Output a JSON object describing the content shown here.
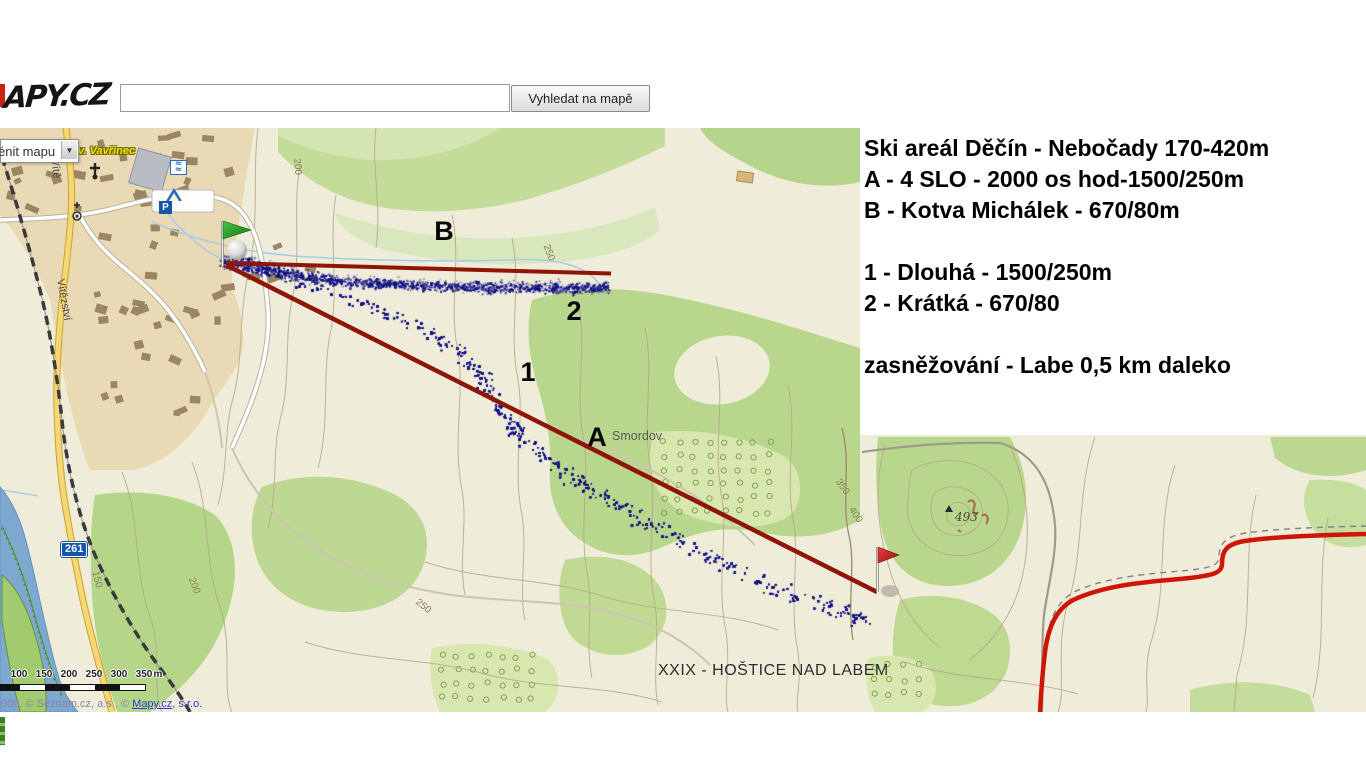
{
  "header": {
    "logo_text": "APY.CZ",
    "search_value": "",
    "search_button_label": "Vyhledat na mapě"
  },
  "map_controls": {
    "change_map_label": "énit mapu"
  },
  "info_panel": {
    "lines": [
      "Ski areál Děčín - Nebočady 170-420m",
      "A - 4 SLO - 2000 os hod-1500/250m",
      "B - Kotva Michálek - 670/80m",
      "",
      "1 - Dlouhá - 1500/250m",
      "2 - Krátká - 670/80",
      "",
      "zasněžování - Labe 0,5 km daleko"
    ]
  },
  "route_markers": [
    {
      "label": "B",
      "x": 444,
      "y": 233
    },
    {
      "label": "2",
      "x": 574,
      "y": 313
    },
    {
      "label": "1",
      "x": 528,
      "y": 374
    },
    {
      "label": "A",
      "x": 597,
      "y": 439
    }
  ],
  "place_labels": [
    {
      "text": "v. Vavřinec",
      "x": 78,
      "y": 145,
      "type": "poi",
      "rot": 0
    },
    {
      "text": "Vítě",
      "x": 60,
      "y": 158,
      "type": "street",
      "rot": 82
    },
    {
      "text": "Vítězství",
      "x": 66,
      "y": 278,
      "type": "street",
      "rot": 80
    },
    {
      "text": "Smordov",
      "x": 612,
      "y": 429,
      "type": "place",
      "rot": 0
    },
    {
      "text": "XXIX - HOŠTICE NAD LABEM",
      "x": 658,
      "y": 662,
      "type": "big",
      "rot": 0
    },
    {
      "text": "493",
      "x": 955,
      "y": 510,
      "type": "summit",
      "rot": 0
    }
  ],
  "contour_labels": [
    {
      "text": "200",
      "x": 302,
      "y": 158,
      "rot": 85
    },
    {
      "text": "250",
      "x": 551,
      "y": 243,
      "rot": 70
    },
    {
      "text": "150",
      "x": 100,
      "y": 570,
      "rot": 75
    },
    {
      "text": "200",
      "x": 196,
      "y": 576,
      "rot": 68
    },
    {
      "text": "250",
      "x": 420,
      "y": 597,
      "rot": 38
    },
    {
      "text": "350",
      "x": 842,
      "y": 477,
      "rot": 55
    },
    {
      "text": "400",
      "x": 855,
      "y": 505,
      "rot": 55
    }
  ],
  "road_shield": {
    "text": "261",
    "x": 61,
    "y": 542
  },
  "scale_bar": {
    "labels": [
      "100",
      "150",
      "200",
      "250",
      "300",
      "350"
    ],
    "unit": "m"
  },
  "attribution": {
    "prefix": "000, © Seznam.cz, a.s., © ",
    "link_text": "Mapy.cz",
    "suffix": ", s.r.o."
  },
  "colors": {
    "ski_line_red": "#8f1607",
    "track_blue": "#15158c",
    "flag_green": "#1fa01f",
    "flag_red": "#d42222",
    "road_red": "#cf1408",
    "forest_green": "#bcd892",
    "water_blue": "#7ea8d0"
  }
}
